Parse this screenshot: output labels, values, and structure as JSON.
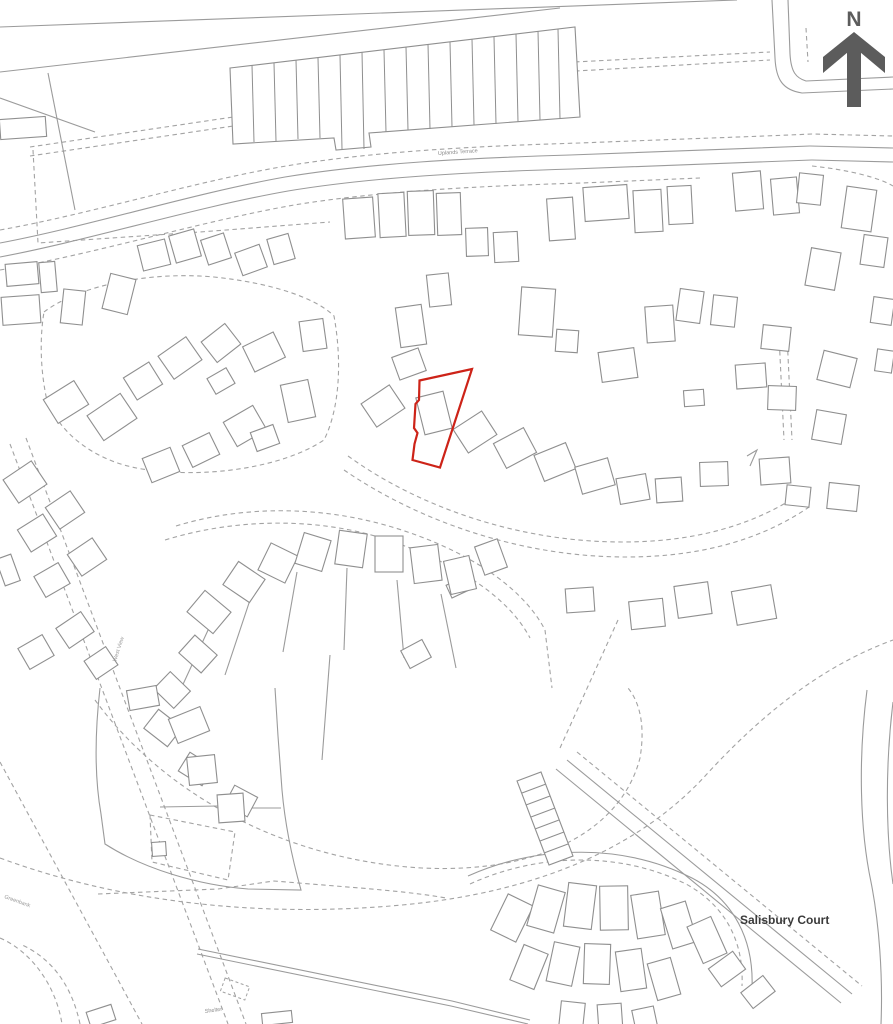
{
  "map": {
    "title": "Site location plan",
    "colors": {
      "line": "#9b9b9b",
      "building": "#8f8f8f",
      "dashed": "#a3a3a3",
      "plot": "#cd2318",
      "north": "#5c5c5c",
      "label": "#8a8a8a"
    },
    "north": {
      "label": "N"
    },
    "labels": [
      {
        "name": "uplands-terrace-label",
        "text": "Uplands Terrace",
        "x": 438,
        "y": 155,
        "size": 5.5,
        "color": "#8a8a8a",
        "rotate": -4,
        "weight": 400
      },
      {
        "name": "salisbury-court-label",
        "text": "Salisbury Court",
        "x": 740,
        "y": 924,
        "size": 12,
        "color": "#3a3a3a",
        "rotate": 0,
        "weight": 600
      },
      {
        "name": "shelter-label",
        "text": "Shelter",
        "x": 205,
        "y": 1013,
        "size": 5.5,
        "color": "#8a8a8a",
        "rotate": -8,
        "weight": 400
      },
      {
        "name": "street-label-west-view",
        "text": "West View",
        "x": 116,
        "y": 662,
        "size": 5.5,
        "color": "#9a9a9a",
        "rotate": -72,
        "weight": 400
      },
      {
        "name": "street-label-greenbank",
        "text": "Greenbank",
        "x": 4,
        "y": 898,
        "size": 5.5,
        "color": "#9a9a9a",
        "rotate": 20,
        "weight": 400
      }
    ],
    "plot": {
      "points": "419.5,380.5 472,369 440,467.5 412.5,460 414.5,444 417.5,433 414,428 415.5,404 419,400",
      "width": 2.2
    },
    "terrace": {
      "outline": "M230,68 L575,27 L580,117 L369,133 L371,147 L336,150 L334,138 L233,144 Z",
      "dividers": [
        [
          252,
          65,
          254,
          142
        ],
        [
          274,
          63,
          276,
          141
        ],
        [
          296,
          60,
          298,
          139
        ],
        [
          318,
          58,
          320,
          138
        ],
        [
          340,
          55,
          342,
          149
        ],
        [
          362,
          52,
          364,
          149
        ],
        [
          384,
          50,
          386,
          132
        ],
        [
          406,
          47,
          408,
          130
        ],
        [
          428,
          44,
          430,
          129
        ],
        [
          450,
          42,
          452,
          127
        ],
        [
          472,
          39,
          474,
          125
        ],
        [
          494,
          37,
          496,
          124
        ],
        [
          516,
          34,
          518,
          122
        ],
        [
          538,
          31,
          540,
          120
        ],
        [
          558,
          29,
          560,
          119
        ]
      ]
    },
    "ladder": {
      "outline": "M517,781 L541,772 L573,856 L549,865 Z",
      "rungs": [
        [
          522,
          793,
          546,
          784
        ],
        [
          526,
          805,
          550,
          796
        ],
        [
          531,
          817,
          555,
          808
        ],
        [
          535,
          829,
          559,
          820
        ],
        [
          540,
          841,
          564,
          832
        ],
        [
          544,
          853,
          568,
          844
        ]
      ]
    },
    "roads_solid": [
      "M0,27 L737,0",
      "M0,72 L560,8",
      "M48,73 L75,210",
      "M0,98 L95,132",
      "M0,243 C90,226 190,194 285,177 C370,163 470,158 570,155 C670,151 740,149 810,146 L893,148",
      "M0,257 C90,240 192,208 288,191 C372,177 472,172 572,169 C672,165 742,163 812,160 L893,162",
      "M772,0 L775,58 C776,80 783,90 802,93 L893,89",
      "M788,0 L790,54 C791,72 796,78 806,81 L893,77",
      "M567,760 L852,994",
      "M556,769 L841,1003",
      "M198,949 L452,1001 L530,1020",
      "M197,954 L451,1006 L528,1024",
      "M867,690 C858,760 860,830 871,882 C879,922 883,975 881,1024",
      "M893,702 C885,768 886,835 893,884",
      "M100,688 C95,732 94,774 101,814 L105,844 C144,869 198,885 248,889 L301,890 C292,858 285,824 282,790 L278,736 L275,688",
      "M160,807 L218,806",
      "M246,808 L281,808",
      "M468,876 C540,844 625,844 692,878 C734,900 754,940 752,988",
      "M747,456 L757,450 L750,466",
      "M209,628 L173,706",
      "M252,594 L225,675",
      "M297,572 L283,652",
      "M347,568 L344,650",
      "M397,580 L404,658",
      "M441,594 L456,668",
      "M330,655 L322,760"
    ],
    "roads_dashed": [
      "M30,147 L240,116 L452,74 L574,62 L770,52",
      "M30,156 L240,125 L454,83 L576,71 L770,60",
      "M33,150 L38,243 L200,232 L330,222",
      "M0,230 C95,213 195,181 292,165 C380,151 480,146 580,143 C680,139 745,137 812,134 L893,136",
      "M0,270 C95,254 198,222 294,205 C380,191 480,186 582,183 L700,178",
      "M806,28 L808,62",
      "M812,166 C850,170 880,178 893,186",
      "M779,335 L784,440",
      "M787,335 L792,440",
      "M44,312 C78,286 148,271 214,277 C272,283 316,298 334,316 C342,360 340,408 324,440 C282,468 204,479 142,469 C92,461 56,430 46,396 C40,366 40,336 44,312",
      "M348,456 C420,508 520,542 622,542 C704,542 762,521 806,490",
      "M344,470 C420,522 522,557 626,557 C708,557 768,536 812,505",
      "M176,526 C244,505 322,506 392,527 C462,548 520,584 544,628",
      "M165,540 C240,517 322,518 388,540 C454,562 508,596 530,638",
      "M545,630 L552,688",
      "M10,444 L228,1024",
      "M26,438 L246,1024",
      "M95,700 C162,792 282,860 422,868 C544,874 622,828 640,758 C646,722 638,700 628,688",
      "M0,858 C122,903 262,918 402,905 C542,892 642,845 706,775 C762,714 822,666 893,640",
      "M98,894 L218,889 L274,881 L360,888 C420,893 440,897 446,898",
      "M470,884 C540,852 622,852 686,884 C726,906 744,942 742,986",
      "M577,752 L862,986",
      "M618,620 L560,748",
      "M0,938 C32,952 56,986 62,1024",
      "M80,1024 C72,986 52,958 20,944",
      "M0,762 L142,1024",
      "M150,815 L235,832 L228,880 L152,862 Z"
    ],
    "buildings": [
      [
        0,
        118,
        46,
        20,
        -4
      ],
      [
        6,
        263,
        32,
        22,
        -5
      ],
      [
        40,
        262,
        16,
        30,
        -5
      ],
      [
        2,
        296,
        38,
        28,
        -4
      ],
      [
        62,
        290,
        22,
        34,
        6
      ],
      [
        106,
        276,
        26,
        36,
        14
      ],
      [
        140,
        242,
        28,
        26,
        -14
      ],
      [
        172,
        232,
        26,
        28,
        -16
      ],
      [
        204,
        236,
        24,
        26,
        -18
      ],
      [
        238,
        248,
        26,
        24,
        -20
      ],
      [
        270,
        236,
        22,
        26,
        -16
      ],
      [
        344,
        198,
        30,
        40,
        -4
      ],
      [
        379,
        193,
        26,
        44,
        -3
      ],
      [
        408,
        191,
        26,
        44,
        -2
      ],
      [
        437,
        193,
        24,
        42,
        -2
      ],
      [
        466,
        228,
        22,
        28,
        -2
      ],
      [
        494,
        232,
        24,
        30,
        -3
      ],
      [
        548,
        198,
        26,
        42,
        -4
      ],
      [
        584,
        186,
        44,
        34,
        -4
      ],
      [
        634,
        190,
        28,
        42,
        -3
      ],
      [
        668,
        186,
        24,
        38,
        -3
      ],
      [
        734,
        172,
        28,
        38,
        -5
      ],
      [
        772,
        178,
        26,
        36,
        -5
      ],
      [
        844,
        188,
        30,
        42,
        8
      ],
      [
        398,
        306,
        26,
        40,
        -8
      ],
      [
        428,
        274,
        22,
        32,
        -6
      ],
      [
        520,
        288,
        34,
        48,
        4
      ],
      [
        556,
        330,
        22,
        22,
        4
      ],
      [
        600,
        350,
        36,
        30,
        -8
      ],
      [
        646,
        306,
        28,
        36,
        -4
      ],
      [
        678,
        290,
        24,
        32,
        8
      ],
      [
        712,
        296,
        24,
        30,
        6
      ],
      [
        736,
        364,
        30,
        24,
        -4
      ],
      [
        684,
        390,
        20,
        16,
        -4
      ],
      [
        762,
        326,
        28,
        24,
        6
      ],
      [
        768,
        386,
        28,
        24,
        2
      ],
      [
        798,
        174,
        24,
        30,
        6
      ],
      [
        808,
        250,
        30,
        38,
        10
      ],
      [
        862,
        236,
        24,
        30,
        8
      ],
      [
        820,
        354,
        34,
        30,
        14
      ],
      [
        814,
        412,
        30,
        30,
        10
      ],
      [
        786,
        486,
        24,
        20,
        6
      ],
      [
        828,
        484,
        30,
        26,
        6
      ],
      [
        872,
        298,
        21,
        26,
        8
      ],
      [
        876,
        350,
        17,
        22,
        8
      ],
      [
        48,
        388,
        36,
        28,
        -32
      ],
      [
        92,
        402,
        40,
        30,
        -34
      ],
      [
        128,
        368,
        30,
        26,
        -32
      ],
      [
        163,
        344,
        34,
        28,
        -35
      ],
      [
        206,
        330,
        30,
        26,
        -38
      ],
      [
        247,
        338,
        34,
        28,
        -26
      ],
      [
        284,
        382,
        28,
        38,
        -12
      ],
      [
        228,
        412,
        34,
        28,
        -30
      ],
      [
        186,
        438,
        30,
        24,
        -26
      ],
      [
        146,
        452,
        30,
        26,
        -22
      ],
      [
        253,
        428,
        24,
        20,
        -20
      ],
      [
        301,
        320,
        24,
        30,
        -8
      ],
      [
        210,
        372,
        22,
        18,
        -30
      ],
      [
        420,
        394,
        28,
        38,
        -14
      ],
      [
        366,
        392,
        34,
        28,
        -34
      ],
      [
        395,
        352,
        28,
        24,
        -20
      ],
      [
        458,
        418,
        34,
        28,
        -33
      ],
      [
        498,
        434,
        34,
        28,
        -28
      ],
      [
        538,
        448,
        34,
        28,
        -22
      ],
      [
        578,
        462,
        34,
        28,
        -16
      ],
      [
        618,
        476,
        30,
        26,
        -10
      ],
      [
        656,
        478,
        26,
        24,
        -4
      ],
      [
        700,
        462,
        28,
        24,
        -2
      ],
      [
        760,
        458,
        30,
        26,
        -4
      ],
      [
        448,
        580,
        22,
        14,
        -25
      ],
      [
        192,
        598,
        34,
        28,
        40
      ],
      [
        228,
        568,
        32,
        28,
        34
      ],
      [
        263,
        548,
        30,
        30,
        26
      ],
      [
        299,
        536,
        28,
        32,
        17
      ],
      [
        337,
        532,
        28,
        34,
        8
      ],
      [
        375,
        536,
        28,
        36,
        0
      ],
      [
        412,
        546,
        28,
        36,
        -7
      ],
      [
        447,
        558,
        26,
        34,
        -13
      ],
      [
        479,
        542,
        24,
        30,
        -20
      ],
      [
        183,
        642,
        30,
        24,
        42
      ],
      [
        158,
        678,
        28,
        24,
        44
      ],
      [
        148,
        716,
        30,
        24,
        38
      ],
      [
        182,
        758,
        28,
        22,
        32
      ],
      [
        228,
        790,
        26,
        22,
        28
      ],
      [
        404,
        644,
        24,
        20,
        -28
      ],
      [
        566,
        588,
        28,
        24,
        -4
      ],
      [
        630,
        600,
        34,
        28,
        -6
      ],
      [
        676,
        584,
        34,
        32,
        -8
      ],
      [
        734,
        588,
        40,
        34,
        -10
      ],
      [
        8,
        468,
        34,
        28,
        -34
      ],
      [
        50,
        497,
        30,
        26,
        -34
      ],
      [
        22,
        520,
        30,
        26,
        -32
      ],
      [
        72,
        544,
        30,
        26,
        -34
      ],
      [
        38,
        568,
        28,
        24,
        -30
      ],
      [
        60,
        618,
        30,
        24,
        -34
      ],
      [
        22,
        640,
        28,
        24,
        -30
      ],
      [
        88,
        652,
        26,
        22,
        -34
      ],
      [
        0,
        556,
        16,
        28,
        -20
      ],
      [
        128,
        688,
        30,
        20,
        -10
      ],
      [
        172,
        712,
        34,
        26,
        -22
      ],
      [
        188,
        756,
        28,
        28,
        -6
      ],
      [
        218,
        794,
        26,
        28,
        -4
      ],
      [
        152,
        842,
        14,
        14,
        -4
      ],
      [
        498,
        898,
        28,
        40,
        26
      ],
      [
        532,
        888,
        28,
        42,
        16
      ],
      [
        566,
        884,
        28,
        44,
        7
      ],
      [
        600,
        886,
        28,
        44,
        -1
      ],
      [
        634,
        893,
        28,
        44,
        -9
      ],
      [
        666,
        904,
        26,
        42,
        -17
      ],
      [
        694,
        920,
        26,
        40,
        -24
      ],
      [
        516,
        948,
        26,
        38,
        22
      ],
      [
        550,
        944,
        26,
        40,
        12
      ],
      [
        584,
        944,
        26,
        40,
        2
      ],
      [
        618,
        950,
        26,
        40,
        -8
      ],
      [
        652,
        960,
        24,
        38,
        -16
      ],
      [
        712,
        958,
        30,
        22,
        -36
      ],
      [
        744,
        982,
        28,
        20,
        -38
      ],
      [
        560,
        1002,
        24,
        26,
        6
      ],
      [
        598,
        1004,
        24,
        26,
        -4
      ],
      [
        634,
        1008,
        22,
        24,
        -12
      ],
      [
        88,
        1008,
        26,
        16,
        -18
      ],
      [
        262,
        1012,
        30,
        12,
        -6
      ]
    ],
    "buildings_dashed": [
      [
        222,
        982,
        26,
        14,
        20
      ]
    ]
  }
}
